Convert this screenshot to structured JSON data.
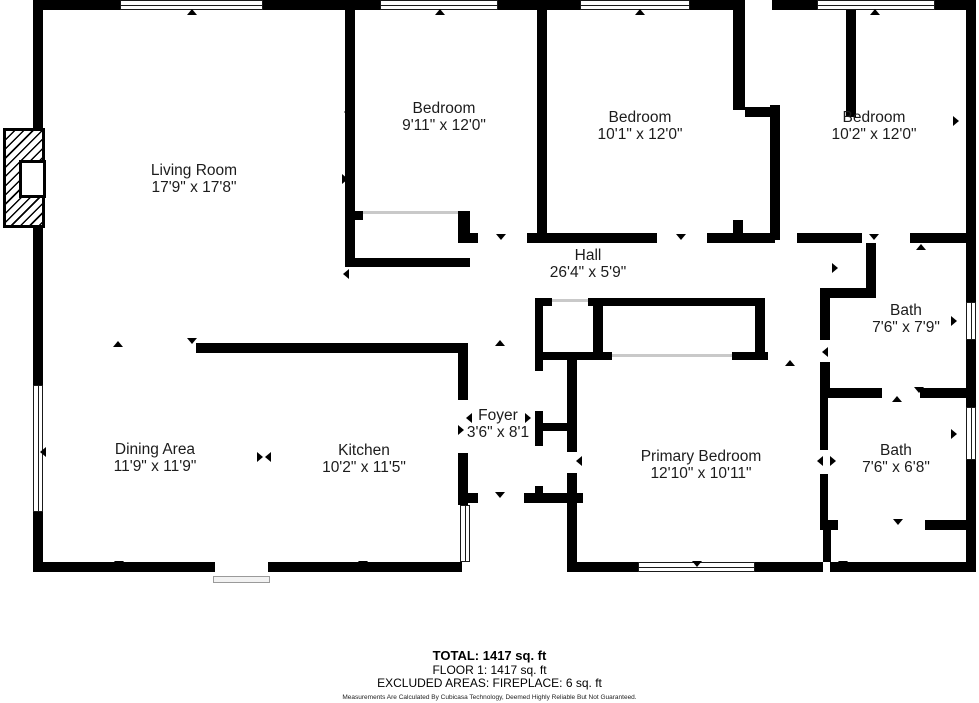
{
  "plan": {
    "width": 979,
    "height": 703,
    "wall_color": "#000000",
    "rooms": [
      {
        "id": "living-room",
        "name": "Living Room",
        "dims": "17'9\" x 17'8\"",
        "x": 194,
        "y": 179
      },
      {
        "id": "bedroom-1",
        "name": "Bedroom",
        "dims": "9'11\" x 12'0\"",
        "x": 444,
        "y": 117
      },
      {
        "id": "bedroom-2",
        "name": "Bedroom",
        "dims": "10'1\" x 12'0\"",
        "x": 640,
        "y": 126
      },
      {
        "id": "bedroom-3",
        "name": "Bedroom",
        "dims": "10'2\" x 12'0\"",
        "x": 874,
        "y": 126
      },
      {
        "id": "hall",
        "name": "Hall",
        "dims": "26'4\" x 5'9\"",
        "x": 588,
        "y": 264
      },
      {
        "id": "bath-1",
        "name": "Bath",
        "dims": "7'6\" x 7'9\"",
        "x": 906,
        "y": 319
      },
      {
        "id": "bath-2",
        "name": "Bath",
        "dims": "7'6\" x 6'8\"",
        "x": 896,
        "y": 459
      },
      {
        "id": "foyer",
        "name": "Foyer",
        "dims": "3'6\" x 8'1",
        "x": 498,
        "y": 424
      },
      {
        "id": "dining-area",
        "name": "Dining Area",
        "dims": "11'9\" x 11'9\"",
        "x": 155,
        "y": 458
      },
      {
        "id": "kitchen",
        "name": "Kitchen",
        "dims": "10'2\" x 11'5\"",
        "x": 364,
        "y": 459
      },
      {
        "id": "primary-bedroom",
        "name": "Primary Bedroom",
        "dims": "12'10\" x 10'11\"",
        "x": 701,
        "y": 465
      }
    ],
    "walls": [
      [
        33,
        0,
        87,
        10
      ],
      [
        263,
        0,
        89,
        10
      ],
      [
        352,
        0,
        28,
        10
      ],
      [
        498,
        0,
        48,
        10
      ],
      [
        546,
        0,
        34,
        10
      ],
      [
        690,
        0,
        55,
        10
      ],
      [
        772,
        0,
        45,
        10
      ],
      [
        935,
        0,
        41,
        10
      ],
      [
        33,
        10,
        10,
        118
      ],
      [
        33,
        128,
        10,
        100
      ],
      [
        33,
        228,
        10,
        157
      ],
      [
        33,
        512,
        10,
        60
      ],
      [
        33,
        562,
        182,
        10
      ],
      [
        268,
        562,
        194,
        10
      ],
      [
        570,
        562,
        68,
        10
      ],
      [
        755,
        562,
        68,
        10
      ],
      [
        830,
        562,
        146,
        10
      ],
      [
        966,
        0,
        10,
        302
      ],
      [
        966,
        340,
        10,
        67
      ],
      [
        966,
        460,
        10,
        112
      ],
      [
        345,
        10,
        10,
        257
      ],
      [
        348,
        211,
        15,
        9
      ],
      [
        458,
        211,
        12,
        32
      ],
      [
        345,
        258,
        125,
        9
      ],
      [
        470,
        233,
        8,
        10
      ],
      [
        527,
        233,
        130,
        10
      ],
      [
        707,
        233,
        68,
        10
      ],
      [
        797,
        233,
        59,
        10
      ],
      [
        733,
        220,
        10,
        13
      ],
      [
        537,
        10,
        10,
        223
      ],
      [
        733,
        10,
        12,
        100
      ],
      [
        745,
        107,
        27,
        10
      ],
      [
        770,
        105,
        10,
        135
      ],
      [
        846,
        10,
        10,
        107
      ],
      [
        846,
        233,
        16,
        10
      ],
      [
        910,
        233,
        66,
        10
      ],
      [
        866,
        243,
        10,
        55
      ],
      [
        820,
        288,
        56,
        10
      ],
      [
        820,
        298,
        10,
        42
      ],
      [
        820,
        362,
        10,
        26
      ],
      [
        820,
        388,
        62,
        10
      ],
      [
        920,
        388,
        56,
        10
      ],
      [
        820,
        398,
        8,
        52
      ],
      [
        820,
        474,
        8,
        46
      ],
      [
        820,
        520,
        18,
        10
      ],
      [
        925,
        520,
        51,
        10
      ],
      [
        823,
        530,
        8,
        32
      ],
      [
        535,
        298,
        8,
        73
      ],
      [
        535,
        411,
        8,
        35
      ],
      [
        535,
        486,
        8,
        17
      ],
      [
        543,
        298,
        9,
        8
      ],
      [
        588,
        298,
        177,
        8
      ],
      [
        593,
        306,
        10,
        51
      ],
      [
        755,
        298,
        10,
        62
      ],
      [
        543,
        352,
        69,
        8
      ],
      [
        732,
        352,
        36,
        8
      ],
      [
        567,
        352,
        10,
        100
      ],
      [
        567,
        473,
        10,
        99
      ],
      [
        543,
        423,
        24,
        8
      ],
      [
        196,
        343,
        271,
        10
      ],
      [
        458,
        343,
        10,
        57
      ],
      [
        458,
        453,
        10,
        52
      ],
      [
        462,
        493,
        16,
        10
      ],
      [
        524,
        493,
        59,
        10
      ]
    ],
    "windows": [
      {
        "x": 120,
        "y": 0,
        "w": 143,
        "h": 10,
        "o": "h"
      },
      {
        "x": 380,
        "y": 0,
        "w": 118,
        "h": 10,
        "o": "h"
      },
      {
        "x": 580,
        "y": 0,
        "w": 110,
        "h": 10,
        "o": "h"
      },
      {
        "x": 817,
        "y": 0,
        "w": 118,
        "h": 10,
        "o": "h"
      },
      {
        "x": 638,
        "y": 562,
        "w": 117,
        "h": 10,
        "o": "h"
      },
      {
        "x": 33,
        "y": 385,
        "w": 10,
        "h": 127,
        "o": "v"
      },
      {
        "x": 966,
        "y": 302,
        "w": 10,
        "h": 38,
        "o": "v"
      },
      {
        "x": 966,
        "y": 407,
        "w": 10,
        "h": 53,
        "o": "v"
      },
      {
        "x": 460,
        "y": 505,
        "w": 10,
        "h": 57,
        "o": "v"
      }
    ],
    "closet_door_lines": [
      [
        363,
        211,
        95,
        3
      ],
      [
        552,
        299,
        36,
        3
      ],
      [
        612,
        354,
        120,
        3
      ]
    ],
    "markers": [
      {
        "x": 192,
        "y": 14,
        "dir": "up"
      },
      {
        "x": 440,
        "y": 14,
        "dir": "up"
      },
      {
        "x": 640,
        "y": 14,
        "dir": "up"
      },
      {
        "x": 875,
        "y": 14,
        "dir": "up"
      },
      {
        "x": 119,
        "y": 566,
        "dir": "down"
      },
      {
        "x": 363,
        "y": 566,
        "dir": "down"
      },
      {
        "x": 697,
        "y": 566,
        "dir": "down"
      },
      {
        "x": 843,
        "y": 566,
        "dir": "down"
      },
      {
        "x": 45,
        "y": 452,
        "dir": "left"
      },
      {
        "x": 956,
        "y": 321,
        "dir": "right"
      },
      {
        "x": 956,
        "y": 434,
        "dir": "right"
      },
      {
        "x": 958,
        "y": 121,
        "dir": "right"
      },
      {
        "x": 501,
        "y": 239,
        "dir": "down"
      },
      {
        "x": 681,
        "y": 239,
        "dir": "down"
      },
      {
        "x": 874,
        "y": 239,
        "dir": "down"
      },
      {
        "x": 921,
        "y": 249,
        "dir": "up"
      },
      {
        "x": 837,
        "y": 268,
        "dir": "right"
      },
      {
        "x": 827,
        "y": 352,
        "dir": "left"
      },
      {
        "x": 919,
        "y": 392,
        "dir": "down"
      },
      {
        "x": 897,
        "y": 401,
        "dir": "up"
      },
      {
        "x": 822,
        "y": 461,
        "dir": "left"
      },
      {
        "x": 835,
        "y": 461,
        "dir": "right"
      },
      {
        "x": 898,
        "y": 524,
        "dir": "down"
      },
      {
        "x": 790,
        "y": 365,
        "dir": "up"
      },
      {
        "x": 581,
        "y": 461,
        "dir": "left"
      },
      {
        "x": 500,
        "y": 497,
        "dir": "down"
      },
      {
        "x": 463,
        "y": 430,
        "dir": "right"
      },
      {
        "x": 471,
        "y": 418,
        "dir": "left"
      },
      {
        "x": 530,
        "y": 418,
        "dir": "right"
      },
      {
        "x": 347,
        "y": 179,
        "dir": "right"
      },
      {
        "x": 348,
        "y": 274,
        "dir": "left"
      },
      {
        "x": 349,
        "y": 112,
        "dir": "left"
      },
      {
        "x": 118,
        "y": 346,
        "dir": "up"
      },
      {
        "x": 192,
        "y": 343,
        "dir": "down"
      },
      {
        "x": 262,
        "y": 457,
        "dir": "right"
      },
      {
        "x": 270,
        "y": 457,
        "dir": "left"
      },
      {
        "x": 500,
        "y": 345,
        "dir": "up"
      }
    ],
    "fireplace": {
      "x": 3,
      "y": 128,
      "w": 42,
      "h": 100,
      "inner": {
        "x": 19,
        "y": 160,
        "w": 27,
        "h": 38
      }
    },
    "porch_step": {
      "x": 213,
      "y": 576,
      "w": 57,
      "h": 7
    }
  },
  "footer": {
    "total": "TOTAL: 1417 sq. ft",
    "floor": "FLOOR 1: 1417 sq. ft",
    "excluded": "EXCLUDED AREAS: FIREPLACE: 6 sq. ft",
    "disclaimer": "Measurements Are Calculated By Cubicasa Technology, Deemed Highly Reliable But Not Guaranteed."
  }
}
